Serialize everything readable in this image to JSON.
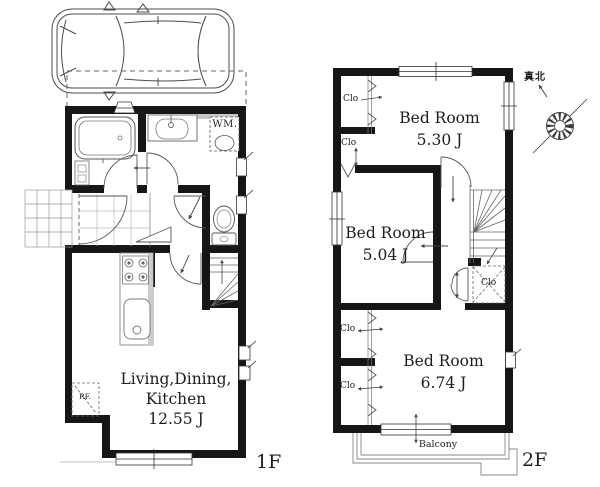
{
  "canvas": {
    "width": 600,
    "height": 487,
    "background": "#ffffff",
    "wall_color": "#161616",
    "line_color": "#555555",
    "text_color": "#1d1d1d"
  },
  "floor1": {
    "floor_label": "1F",
    "ldk_label_line1": "Living,Dining,",
    "ldk_label_line2": "Kitchen",
    "ldk_area": "12.55 J",
    "washing_machine_label": "WM.",
    "refrigerator_label": "RF."
  },
  "floor2": {
    "floor_label": "2F",
    "bedroom_top_name": "Bed Room",
    "bedroom_top_area": "5.30 J",
    "bedroom_mid_name": "Bed Room",
    "bedroom_mid_area": "5.04 J",
    "bedroom_bottom_name": "Bed Room",
    "bedroom_bottom_area": "6.74 J",
    "closet_labels": [
      "Clo",
      "Clo",
      "Clo",
      "Clo",
      "Clo"
    ],
    "balcony_label": "Balcony"
  },
  "compass": {
    "north_label": "真北"
  }
}
